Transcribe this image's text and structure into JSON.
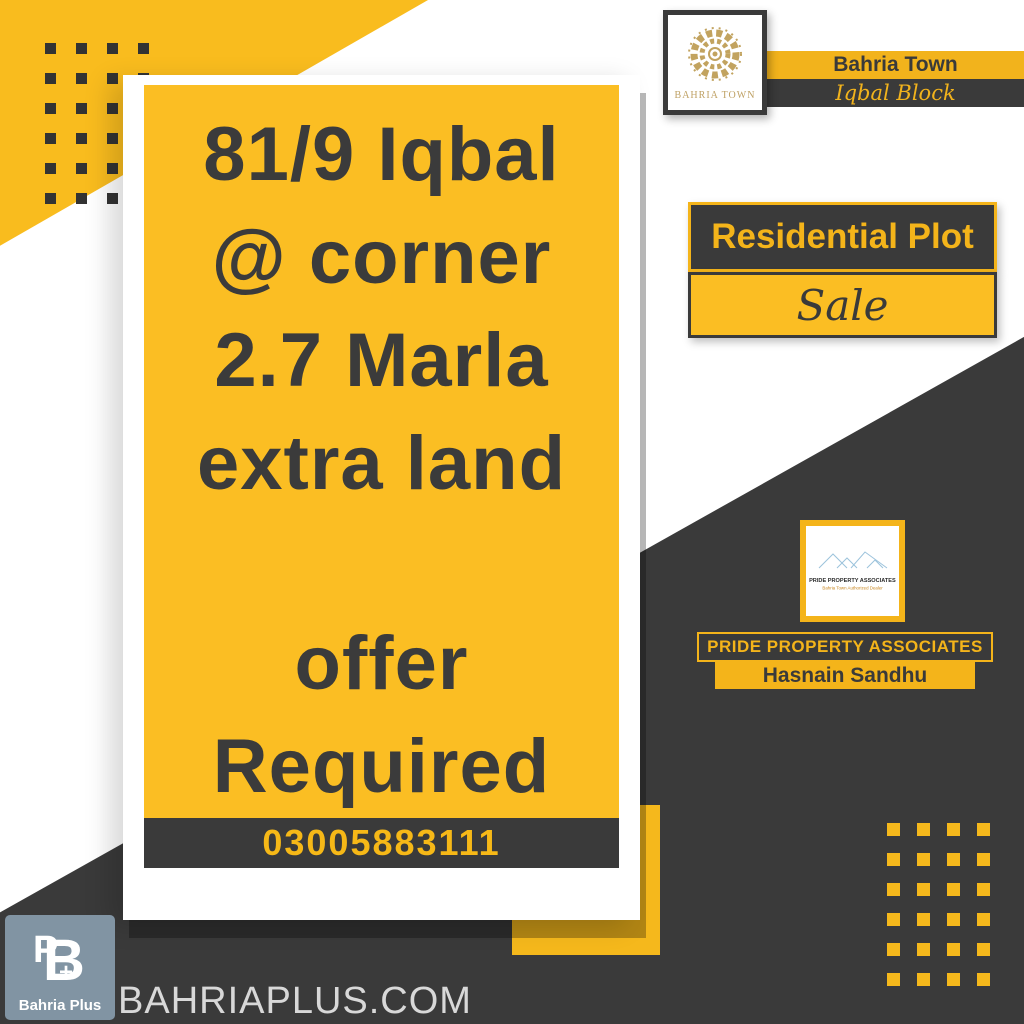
{
  "developer": {
    "emblem_icon": "bahria-town-emblem-icon",
    "logo_caption": "BAHRIA TOWN",
    "project_name": "Bahria Town",
    "block_name": "Iqbal Block"
  },
  "listing": {
    "line1": "81/9 Iqbal",
    "line2": "@ corner",
    "line3": "2.7 Marla",
    "line4": "extra land",
    "line5": "offer",
    "line6": "Required",
    "phone": "03005883111"
  },
  "property": {
    "type_label": "Residential Plot",
    "status_label": "Sale"
  },
  "agency": {
    "logo_title": "PRIDE PROPERTY ASSOCIATES",
    "logo_subtitle": "Bahria Town Authorized Dealer",
    "name": "PRIDE PROPERTY ASSOCIATES",
    "agent_name": "Hasnain Sandhu"
  },
  "footer": {
    "brand_name": "Bahria Plus",
    "monogram_b": "B",
    "monogram_p": "P",
    "monogram_plus": "+",
    "website": "BAHRIAPLUS.COM"
  },
  "colors": {
    "accent_yellow": "#F9BC1E",
    "dark": "#3A3A3A",
    "gold": "#BFA164",
    "slate_blue": "#8194A3",
    "light_text": "#D8D8D8"
  }
}
